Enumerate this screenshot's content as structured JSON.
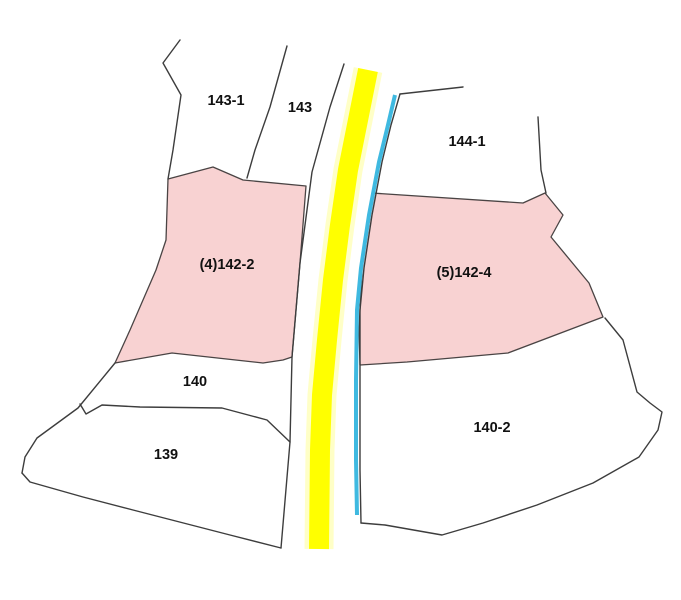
{
  "map": {
    "width": 681,
    "height": 600,
    "colors": {
      "background": "#ffffff",
      "boundary_line": "#3d3d3d",
      "highlight_fill": "#f8d2d2",
      "highlight_border": "#4a4444",
      "road_core": "#ffff00",
      "road_glow": "#ffff99",
      "waterway": "#3fb9e0",
      "label_text": "#111111"
    },
    "parcels": [
      {
        "label": "143-1",
        "label_x": 226,
        "label_y": 105,
        "highlighted": false
      },
      {
        "label": "143",
        "label_x": 300,
        "label_y": 112,
        "highlighted": false
      },
      {
        "label": "144-1",
        "label_x": 467,
        "label_y": 146,
        "highlighted": false
      },
      {
        "label": "(4)142-2",
        "label_x": 227,
        "label_y": 269,
        "highlighted": true,
        "polygon": [
          [
            168,
            179
          ],
          [
            213,
            167
          ],
          [
            243,
            180
          ],
          [
            306,
            186
          ],
          [
            300,
            263
          ],
          [
            292,
            357
          ],
          [
            283,
            360
          ],
          [
            263,
            363
          ],
          [
            172,
            353
          ],
          [
            115,
            363
          ],
          [
            130,
            330
          ],
          [
            156,
            270
          ],
          [
            166,
            240
          ]
        ]
      },
      {
        "label": "(5)142-4",
        "label_x": 464,
        "label_y": 277,
        "highlighted": true,
        "polygon": [
          [
            372,
            193
          ],
          [
            523,
            203
          ],
          [
            545,
            193
          ],
          [
            563,
            215
          ],
          [
            551,
            237
          ],
          [
            589,
            283
          ],
          [
            603,
            317
          ],
          [
            508,
            353
          ],
          [
            407,
            362
          ],
          [
            360,
            365
          ],
          [
            359,
            330
          ],
          [
            362,
            268
          ],
          [
            371,
            210
          ]
        ]
      },
      {
        "label": "140",
        "label_x": 195,
        "label_y": 386,
        "highlighted": false
      },
      {
        "label": "139",
        "label_x": 166,
        "label_y": 459,
        "highlighted": false
      },
      {
        "label": "140-2",
        "label_x": 492,
        "label_y": 432,
        "highlighted": false
      }
    ],
    "boundaries": [
      {
        "name": "boundary-west-zigzag",
        "points": [
          [
            180,
            40
          ],
          [
            163,
            63
          ],
          [
            181,
            95
          ],
          [
            173,
            150
          ],
          [
            168,
            179
          ]
        ]
      },
      {
        "name": "boundary-143-1-143",
        "points": [
          [
            287,
            46
          ],
          [
            270,
            107
          ],
          [
            255,
            150
          ],
          [
            247,
            178
          ]
        ]
      },
      {
        "name": "boundary-road-west",
        "points": [
          [
            344,
            64
          ],
          [
            330,
            107
          ],
          [
            312,
            172
          ],
          [
            300,
            263
          ],
          [
            292,
            357
          ],
          [
            290,
            442
          ],
          [
            281,
            548
          ]
        ]
      },
      {
        "name": "boundary-144-1-top",
        "points": [
          [
            400,
            94
          ],
          [
            463,
            87
          ]
        ]
      },
      {
        "name": "boundary-144-1-east",
        "points": [
          [
            538,
            117
          ],
          [
            541,
            170
          ],
          [
            546,
            193
          ]
        ]
      },
      {
        "name": "boundary-water-east",
        "points": [
          [
            400,
            94
          ],
          [
            391,
            125
          ],
          [
            382,
            162
          ],
          [
            372,
            215
          ],
          [
            364,
            268
          ],
          [
            360,
            310
          ],
          [
            360,
            380
          ],
          [
            360,
            470
          ],
          [
            361,
            523
          ]
        ]
      },
      {
        "name": "boundary-140-2",
        "points": [
          [
            361,
            523
          ],
          [
            385,
            525
          ],
          [
            442,
            535
          ],
          [
            483,
            523
          ],
          [
            537,
            505
          ],
          [
            593,
            483
          ],
          [
            639,
            457
          ],
          [
            658,
            430
          ],
          [
            662,
            412
          ],
          [
            650,
            403
          ],
          [
            637,
            392
          ],
          [
            623,
            340
          ],
          [
            605,
            318
          ]
        ]
      },
      {
        "name": "boundary-sw-diagonal",
        "points": [
          [
            115,
            363
          ],
          [
            78,
            408
          ],
          [
            37,
            438
          ],
          [
            25,
            457
          ],
          [
            22,
            473
          ]
        ]
      },
      {
        "name": "boundary-139-south",
        "points": [
          [
            22,
            473
          ],
          [
            30,
            482
          ],
          [
            83,
            497
          ],
          [
            133,
            510
          ],
          [
            230,
            535
          ],
          [
            281,
            548
          ]
        ]
      },
      {
        "name": "boundary-140-139",
        "points": [
          [
            80,
            404
          ],
          [
            86,
            414
          ],
          [
            102,
            405
          ],
          [
            140,
            407
          ],
          [
            222,
            408
          ],
          [
            267,
            420
          ],
          [
            290,
            442
          ]
        ]
      }
    ],
    "road": {
      "name": "road-highlight",
      "points": [
        [
          368,
          70
        ],
        [
          357,
          125
        ],
        [
          348,
          170
        ],
        [
          340,
          225
        ],
        [
          333,
          280
        ],
        [
          327,
          340
        ],
        [
          322,
          395
        ],
        [
          320,
          450
        ],
        [
          319,
          549
        ]
      ],
      "core_width": 20,
      "glow_width": 29
    },
    "waterway": {
      "name": "waterway-line",
      "points": [
        [
          395,
          95
        ],
        [
          388,
          125
        ],
        [
          379,
          162
        ],
        [
          369,
          215
        ],
        [
          361,
          268
        ],
        [
          357,
          310
        ],
        [
          356,
          380
        ],
        [
          356,
          460
        ],
        [
          357,
          515
        ]
      ],
      "width": 4
    }
  }
}
